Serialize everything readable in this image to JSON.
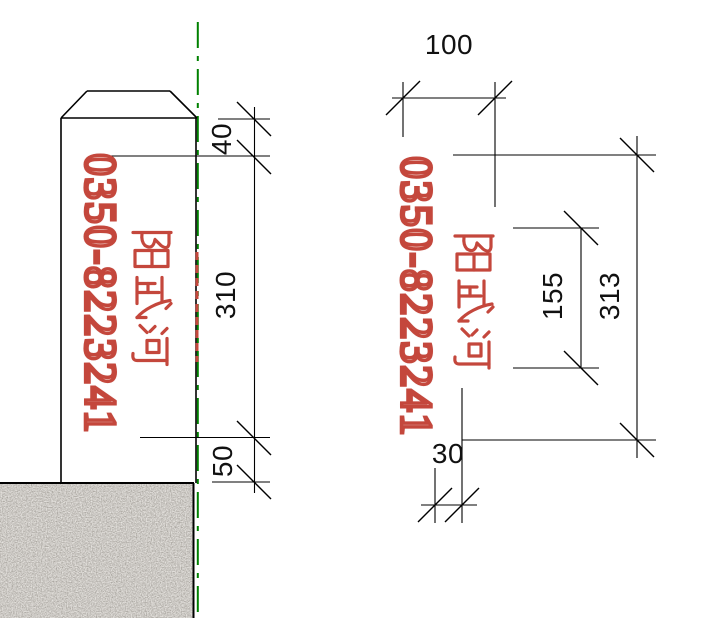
{
  "drawing": {
    "title": "boundary-marker-post-drawing",
    "marker_text": {
      "phone": "0350-8223241",
      "river_name": "阳武河"
    },
    "left_view": {
      "dim_top": "40",
      "dim_middle": "310",
      "dim_bottom": "50"
    },
    "right_view": {
      "dim_width": "100",
      "dim_inner_height": "155",
      "dim_total_height": "313",
      "dim_offset": "30"
    },
    "colors": {
      "accent_red": "#c4473c",
      "accent_red_dark": "#7a1a10",
      "centerline_green": "#008000",
      "line_black": "#000000",
      "ground_base": "#cdc5b9"
    }
  }
}
